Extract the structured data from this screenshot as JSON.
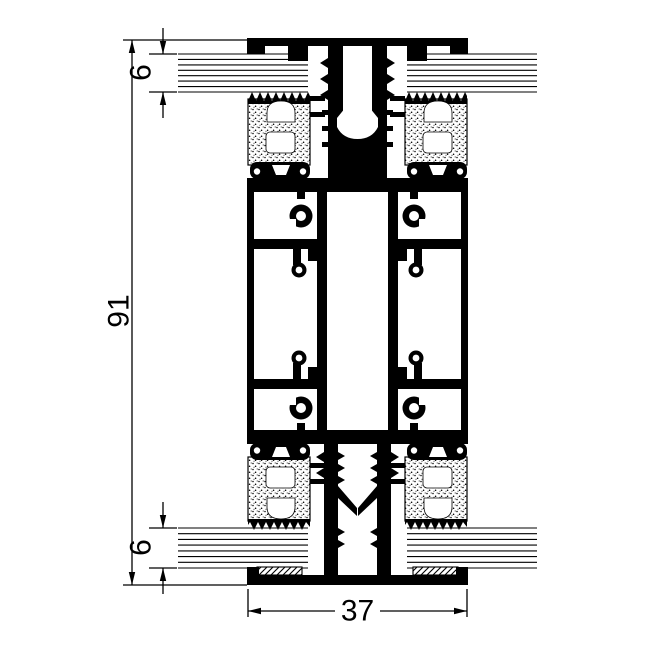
{
  "drawing": {
    "kind": "aluminum-profile-cross-section",
    "dimensions": {
      "overall_height": "91",
      "glazing_top": "6",
      "glazing_bottom": "6",
      "cap_width": "37"
    },
    "colors": {
      "ink": "#000000",
      "paper": "#ffffff"
    }
  }
}
